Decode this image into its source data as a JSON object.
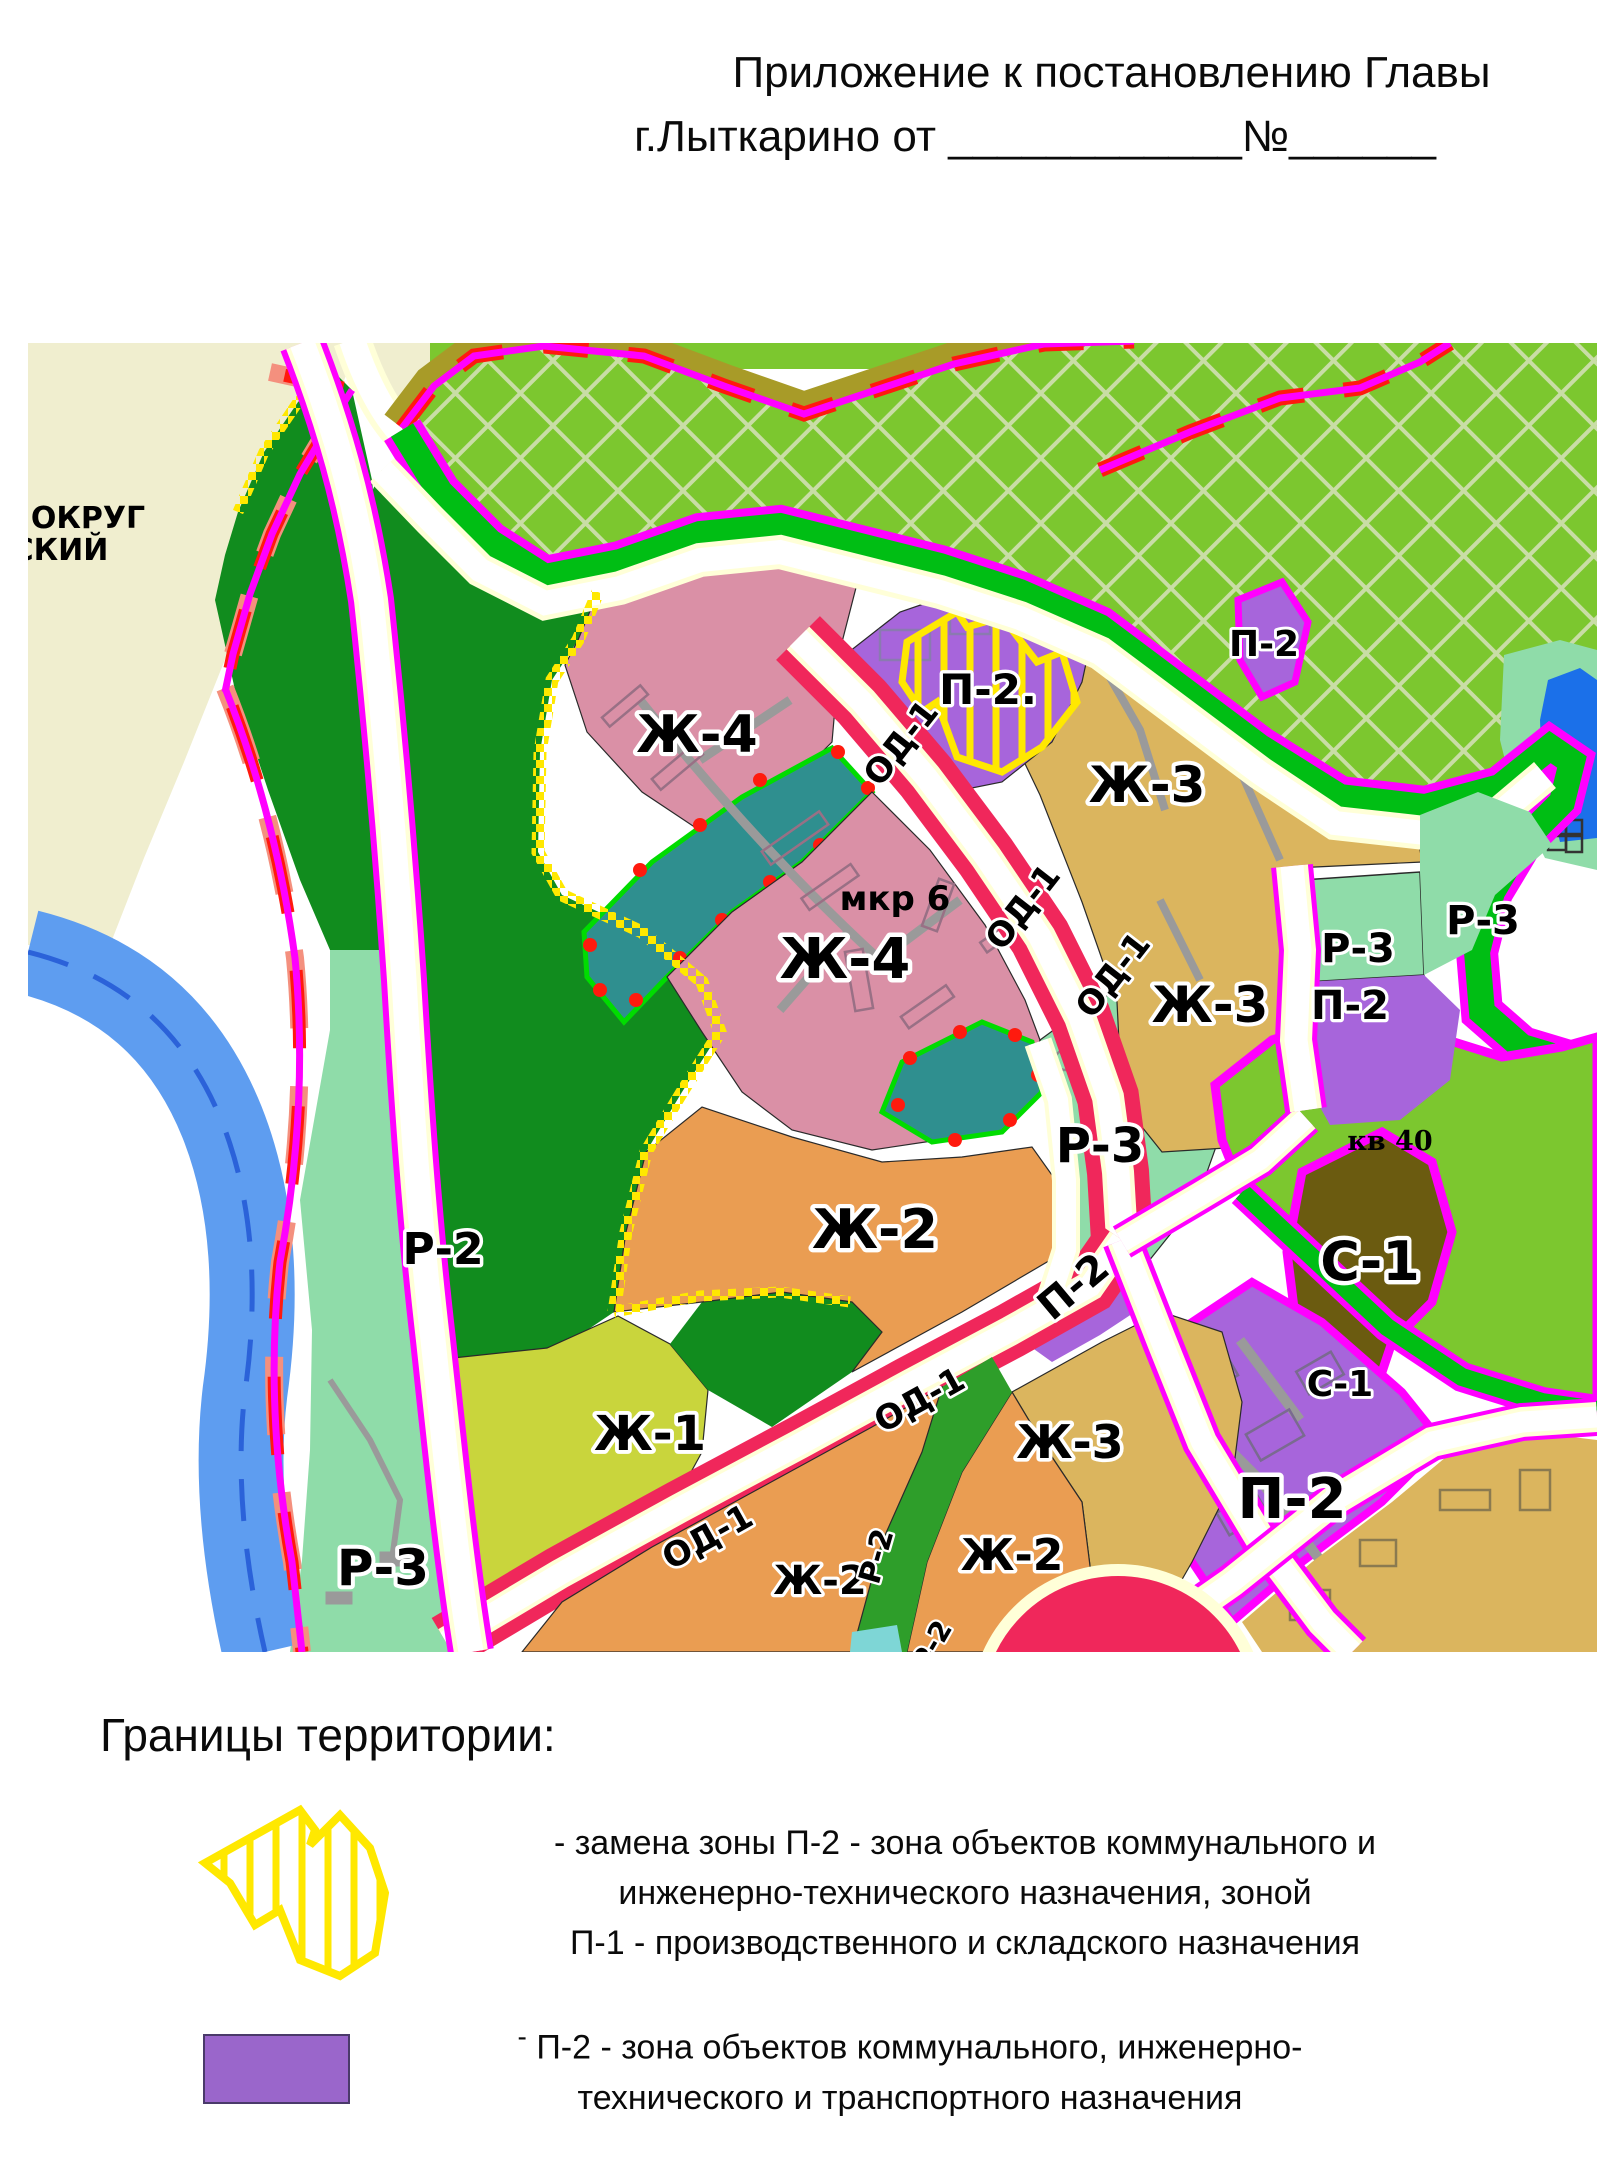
{
  "header": {
    "line1": "Приложение к постановлению Главы",
    "line2": "г.Лыткарино от ____________№______"
  },
  "map": {
    "neighbor_labels": [
      "ОКРУГ",
      "СКИЙ"
    ],
    "district_note": "мкр 6",
    "quarter_note": "кв 40",
    "zone_codes": [
      "Ж-1",
      "Ж-2",
      "Ж-3",
      "Ж-4",
      "Р-2",
      "Р-3",
      "П-2",
      "П-1",
      "ОД-1",
      "С-1"
    ],
    "colors": {
      "residential_high": "#da90a6",
      "residential_mid_tan": "#dbb55e",
      "residential_mid_orange": "#ea9d52",
      "residential_low": "#c9d53c",
      "public_business": "#f0275b",
      "industrial_utility": "#a765db",
      "recreation_forest": "#118c1e",
      "recreation_light": "#8fdca9",
      "recreation_hatched": "#7cc72f",
      "special": "#6b5b10",
      "water": "#5e9df0",
      "boundary_magenta": "#ff00ff",
      "boundary_red": "#ff1a0e",
      "boundary_green": "#00be14",
      "replace_hatch_yellow": "#ffe800",
      "outside_beige": "#f0eecf"
    },
    "region_labels": [
      {
        "t": "ОКРУГ",
        "x": 88,
        "y": 528,
        "s": 30
      },
      {
        "t": "СКИЙ",
        "x": 60,
        "y": 560,
        "s": 30
      },
      {
        "t": "Ж-4",
        "x": 697,
        "y": 752,
        "s": 52,
        "h": true
      },
      {
        "t": "Ж-4",
        "x": 845,
        "y": 978,
        "s": 56,
        "h": true
      },
      {
        "t": "мкр 6",
        "x": 895,
        "y": 910,
        "s": 34
      },
      {
        "t": "Ж-3",
        "x": 1147,
        "y": 802,
        "s": 50,
        "h": true
      },
      {
        "t": "Ж-3",
        "x": 1210,
        "y": 1022,
        "s": 50,
        "h": true
      },
      {
        "t": "Ж-3",
        "x": 1070,
        "y": 1458,
        "s": 46,
        "h": true
      },
      {
        "t": "Ж-2",
        "x": 875,
        "y": 1248,
        "s": 54,
        "h": true
      },
      {
        "t": "Ж-2",
        "x": 820,
        "y": 1594,
        "s": 40,
        "h": true
      },
      {
        "t": "Ж-2",
        "x": 1012,
        "y": 1570,
        "s": 44,
        "h": true
      },
      {
        "t": "Ж-1",
        "x": 650,
        "y": 1450,
        "s": 48,
        "h": true
      },
      {
        "t": "Р-2",
        "x": 443,
        "y": 1264,
        "s": 44,
        "h": true
      },
      {
        "t": "Р-3",
        "x": 383,
        "y": 1585,
        "s": 50,
        "h": true
      },
      {
        "t": "Р-3",
        "x": 1100,
        "y": 1162,
        "s": 48,
        "h": true
      },
      {
        "t": "Р-3",
        "x": 1358,
        "y": 962,
        "s": 40,
        "h": true
      },
      {
        "t": "Р-3",
        "x": 1483,
        "y": 934,
        "s": 40,
        "h": true
      },
      {
        "t": "П-2",
        "x": 1350,
        "y": 1019,
        "s": 40,
        "h": true
      },
      {
        "t": "П-2.",
        "x": 988,
        "y": 704,
        "s": 42,
        "h": true
      },
      {
        "t": "П-2",
        "x": 1264,
        "y": 656,
        "s": 36,
        "h": true
      },
      {
        "t": "П-2",
        "x": 1292,
        "y": 1518,
        "s": 56,
        "h": true
      },
      {
        "t": "П-2",
        "x": 1082,
        "y": 1297,
        "s": 40,
        "h": true,
        "r": -40
      },
      {
        "t": "С-1",
        "x": 1370,
        "y": 1280,
        "s": 54,
        "h": true
      },
      {
        "t": "С-1",
        "x": 1340,
        "y": 1396,
        "s": 36,
        "h": true
      },
      {
        "t": "кв 40",
        "x": 1390,
        "y": 1150,
        "s": 27,
        "f": "serif"
      },
      {
        "t": "ОД-1",
        "x": 910,
        "y": 750,
        "s": 34,
        "h": true,
        "r": -52
      },
      {
        "t": "ОД-1",
        "x": 1032,
        "y": 914,
        "s": 34,
        "h": true,
        "r": -52
      },
      {
        "t": "ОД-1",
        "x": 1122,
        "y": 982,
        "s": 34,
        "h": true,
        "r": -52
      },
      {
        "t": "ОД-1",
        "x": 713,
        "y": 1547,
        "s": 34,
        "h": true,
        "r": -29
      },
      {
        "t": "ОД-1",
        "x": 925,
        "y": 1410,
        "s": 34,
        "h": true,
        "r": -29
      },
      {
        "t": "Р-2",
        "x": 886,
        "y": 1559,
        "s": 30,
        "h": true,
        "r": -74
      },
      {
        "t": "Р-2",
        "x": 940,
        "y": 1650,
        "s": 28,
        "h": true,
        "r": -60
      }
    ]
  },
  "legend": {
    "title": "Границы территории:",
    "items": [
      {
        "symbol": "hatched-yellow-area",
        "lines": [
          "- замена зоны П-2 - зона объектов коммунального и",
          "инженерно-технического назначения, зоной",
          "П-1 - производственного и складского назначения"
        ]
      },
      {
        "symbol": "purple-swatch",
        "prefix": "-",
        "lines": [
          "П-2 - зона объектов коммунального, инженерно-",
          "технического и транспортного назначения"
        ]
      }
    ]
  }
}
